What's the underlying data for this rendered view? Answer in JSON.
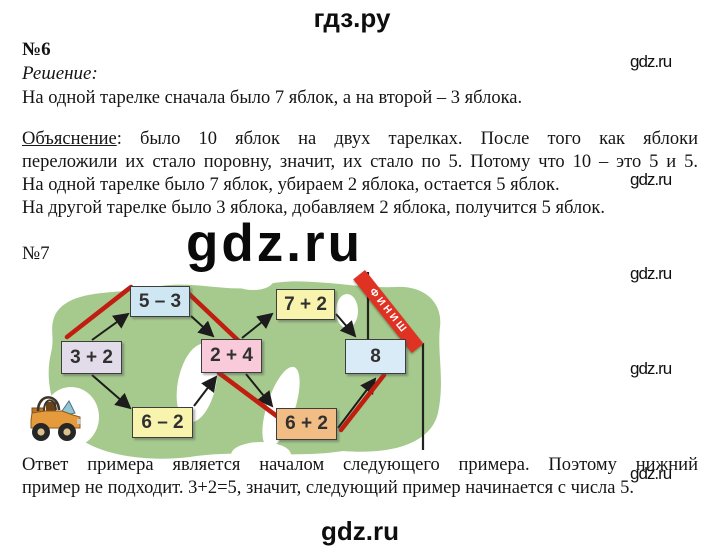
{
  "header": {
    "logo": "гдз.ру"
  },
  "watermarks": {
    "label": "gdz.ru",
    "center_label": "gdz.ru"
  },
  "task6": {
    "number": "№6",
    "solution_label": "Решение:",
    "solution_text": "На одной тарелке сначала было 7 яблок, а на второй – 3 яблока.",
    "explanation_label": "Объяснение",
    "explanation_lines": [
      ": было 10 яблок на двух тарелках. После того как яблоки",
      "переложили их стало поровну, значит, их стало по 5. Потому что 10 – это 5 и 5.",
      "На одной тарелке было 7 яблок, убираем 2 яблока, остается 5 яблок.",
      "На другой тарелке было 3 яблока, добавляем 2 яблока, получится 5 яблок."
    ]
  },
  "task7": {
    "number": "№7",
    "diagram": {
      "finish_label": "ФИНИШ",
      "start_icon": "jeep-icon",
      "field_color": "#a6ca8d",
      "route_color": "#c11e12",
      "boxes": [
        {
          "label": "3 + 2",
          "color": "#e2dbe9"
        },
        {
          "label": "5 – 3",
          "color": "#cfe6f3"
        },
        {
          "label": "6 – 2",
          "color": "#f8f4ae"
        },
        {
          "label": "2 + 4",
          "color": "#f8cada"
        },
        {
          "label": "7 + 2",
          "color": "#f8f4ae"
        },
        {
          "label": "6 + 2",
          "color": "#f2bd85"
        },
        {
          "label": "8",
          "color": "#d9ebf6"
        }
      ]
    },
    "answer_lines": [
      "Ответ примера является началом следующего примера. Поэтому нижний",
      "пример не подходит. 3+2=5, значит, следующий пример начинается с числа 5."
    ]
  },
  "footer": {
    "logo": "gdz.ru"
  }
}
